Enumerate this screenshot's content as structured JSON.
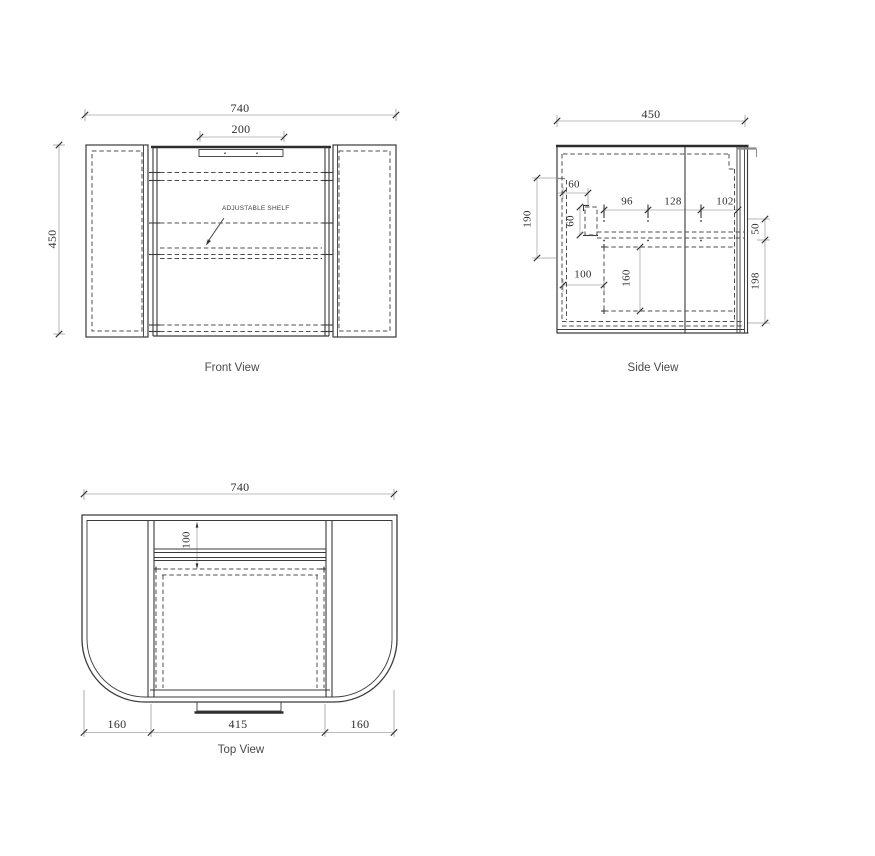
{
  "drawing": {
    "front_view": {
      "caption": "Front View",
      "shelf_label": "ADJUSTABLE SHELF",
      "dim_overall_width": "740",
      "dim_handle_width": "200",
      "dim_overall_height": "450"
    },
    "side_view": {
      "caption": "Side View",
      "dim_depth": "450",
      "dim_60_horizontal": "60",
      "dim_60_vertical": "60",
      "dim_96": "96",
      "dim_128": "128",
      "dim_102": "102",
      "dim_190": "190",
      "dim_100": "100",
      "dim_160": "160",
      "dim_50": "50",
      "dim_198": "198"
    },
    "top_view": {
      "caption": "Top View",
      "dim_overall_width": "740",
      "dim_100": "100",
      "dim_left_overhang": "160",
      "dim_opening": "415",
      "dim_right_overhang": "160"
    }
  }
}
